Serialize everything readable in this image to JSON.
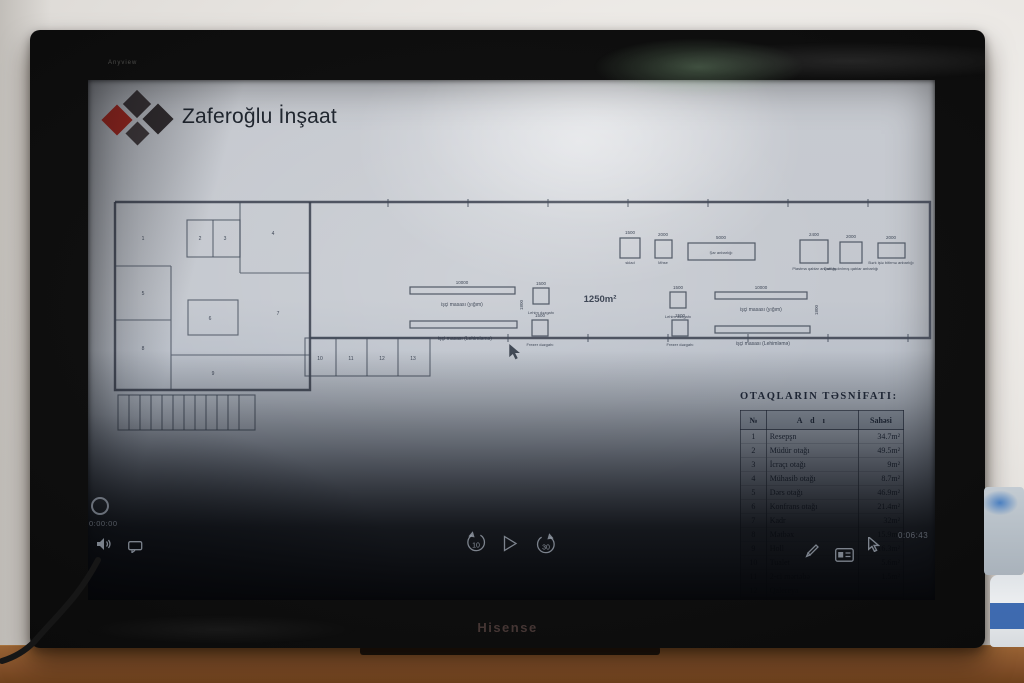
{
  "scene": {
    "tv_brand": "Hisense",
    "bezel_label": "Anyview"
  },
  "slide": {
    "company": "Zaferoğlu İnşaat",
    "brand_red": "#a8291f",
    "brand_dark": "#3a3436",
    "area_label": "1250m²",
    "plan": {
      "desk_labels": [
        "işçi masası (yığım)",
        "işçi masası (Lehimləmə)",
        "işçi masası (yığım)",
        "işçi masası (Lehimləmə)"
      ],
      "machine_labels": [
        "Lehim dəzgahı",
        "Frezer dəzgahı",
        "Lehim dəzgahı",
        "Frezer dəzgahı"
      ],
      "storage_labels": [
        "sklad",
        "Mhse",
        "Şar anbarlığı",
        "Plastma qablar anbarlığı",
        "Qablaşdırılmış qablar anbarlığı",
        "Bərk işlə bitirmə anbarlığı"
      ],
      "dims": [
        "10000",
        "10000",
        "1500",
        "1500",
        "1500",
        "1500",
        "2400",
        "2000",
        "2000",
        "5000",
        "1500",
        "2000",
        "1800",
        "1800"
      ],
      "room_numbers": [
        "1",
        "2",
        "3",
        "4",
        "5",
        "6",
        "7",
        "8",
        "9",
        "10",
        "11",
        "12",
        "13"
      ]
    },
    "table": {
      "title": "OTAQLARIN TƏSNİFATI:",
      "headers": [
        "№",
        "A d ı",
        "Sahəsi"
      ],
      "rows": [
        [
          "1",
          "Resepşn",
          "34.7m²"
        ],
        [
          "2",
          "Müdür otağı",
          "49.5m²"
        ],
        [
          "3",
          "İcraçı otağı",
          "9m²"
        ],
        [
          "4",
          "Mühasib otağı",
          "8.7m²"
        ],
        [
          "5",
          "Dərs otağı",
          "46.9m²"
        ],
        [
          "6",
          "Konfrans otağı",
          "21.4m²"
        ],
        [
          "7",
          "Kadr",
          "32m²"
        ],
        [
          "8",
          "Mətbəx",
          "15.9m²"
        ],
        [
          "9",
          "Holl",
          "16.3m²"
        ],
        [
          "10",
          "Tualet",
          "5.6m²"
        ],
        [
          "11",
          "2-ci mərtəbə",
          "1.5m²"
        ],
        [
          "12",
          "Qalereya",
          ""
        ],
        [
          "13",
          "",
          ""
        ]
      ]
    }
  },
  "player": {
    "elapsed": "0:00:00",
    "duration": "0:06:43",
    "rewind_seconds": "10",
    "forward_seconds": "30"
  }
}
